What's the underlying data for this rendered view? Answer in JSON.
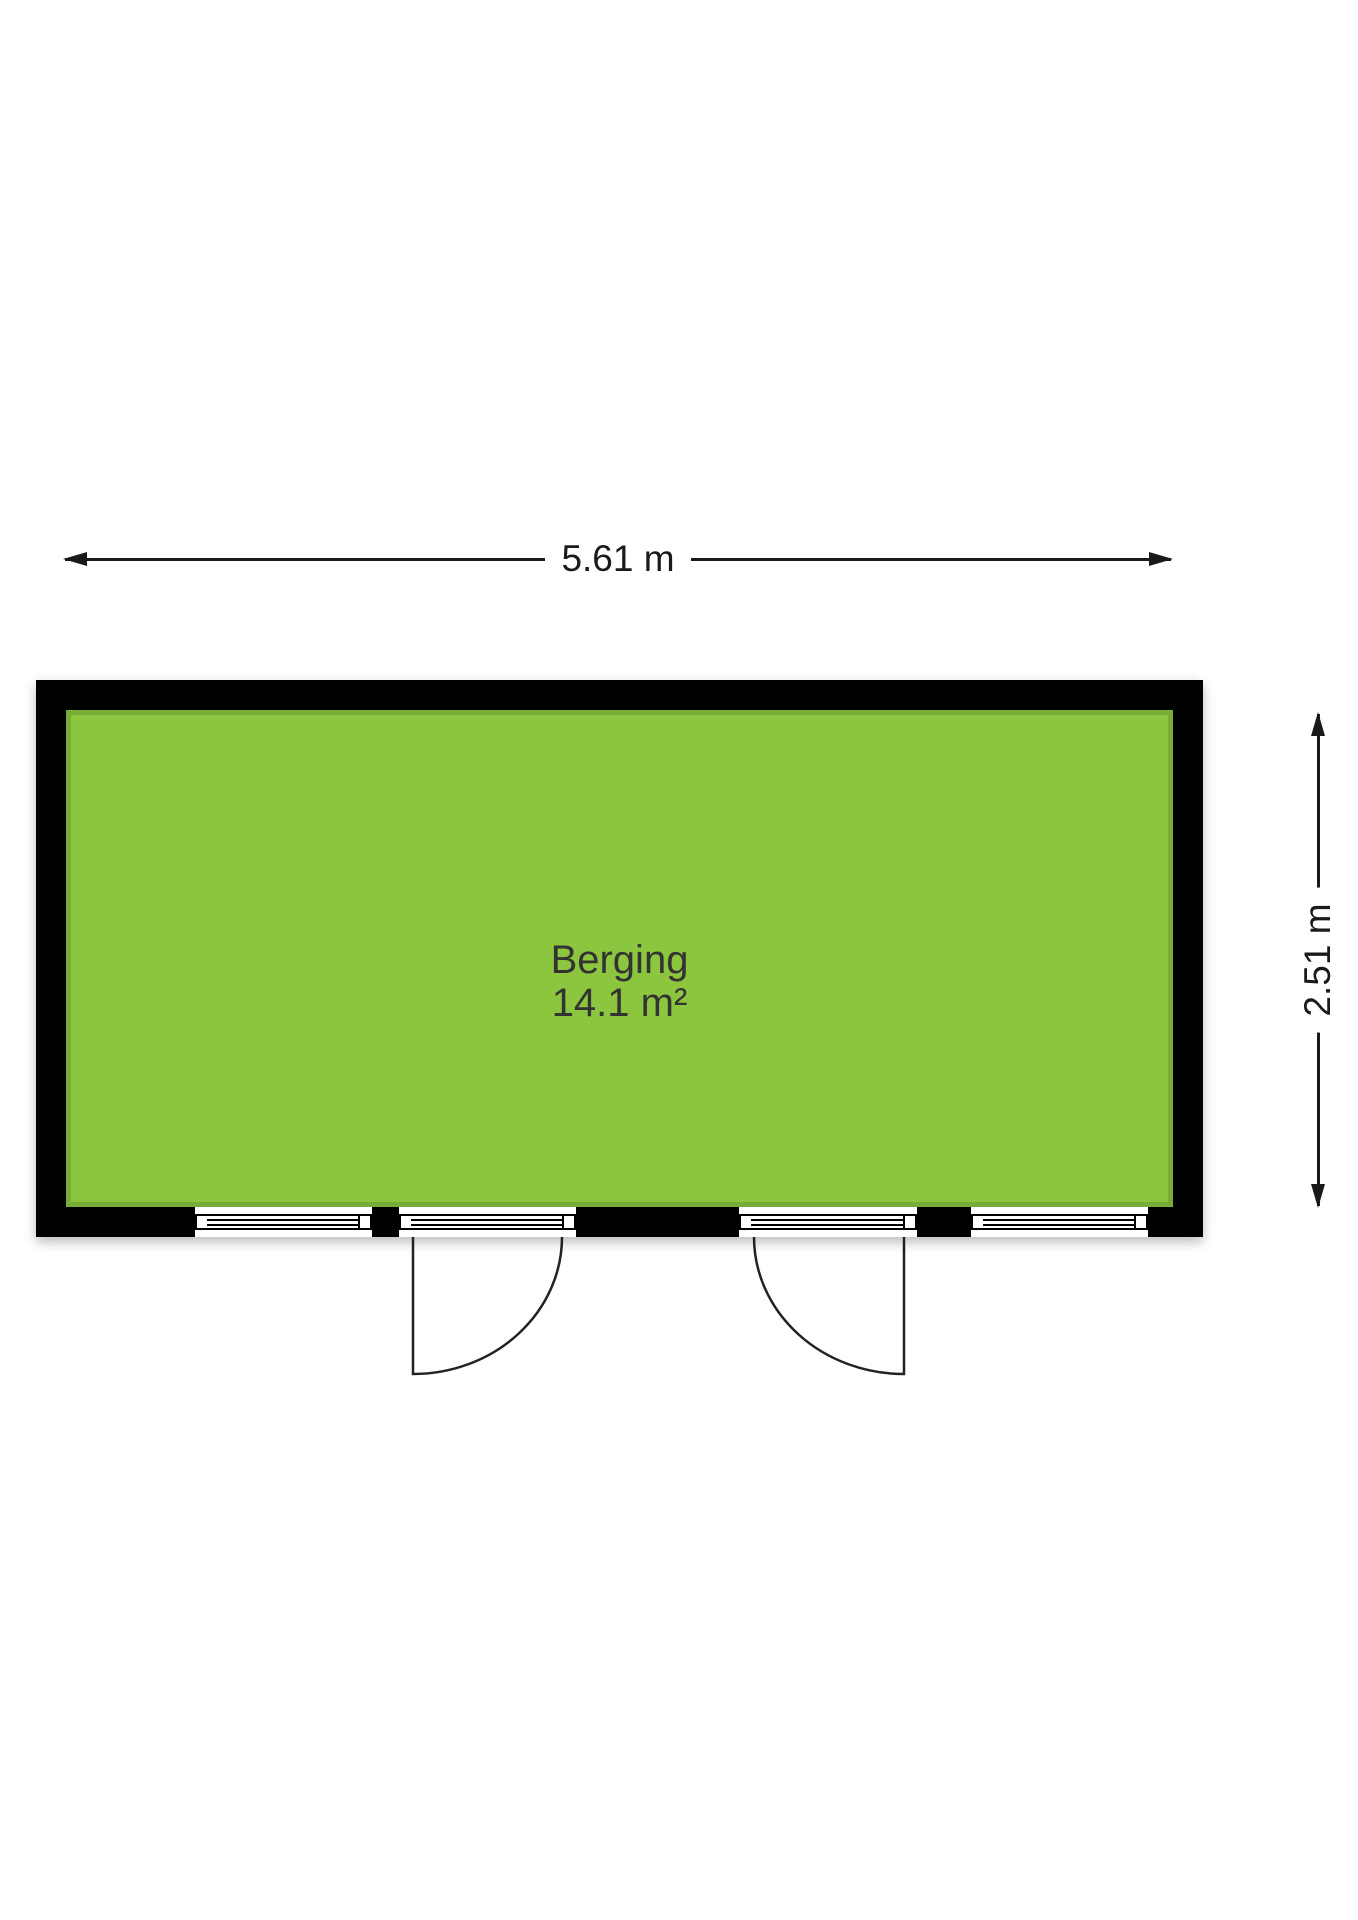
{
  "room": {
    "name": "Berging",
    "area": "14.1 m²"
  },
  "dimensions": {
    "width_label": "5.61 m",
    "height_label": "2.51 m"
  },
  "colors": {
    "floor_fill": "#8cc63e",
    "floor_edge": "#79ab36",
    "wall": "#000000",
    "dimension_line": "#1a1a1a",
    "room_text": "#333333",
    "background": "#ffffff"
  }
}
